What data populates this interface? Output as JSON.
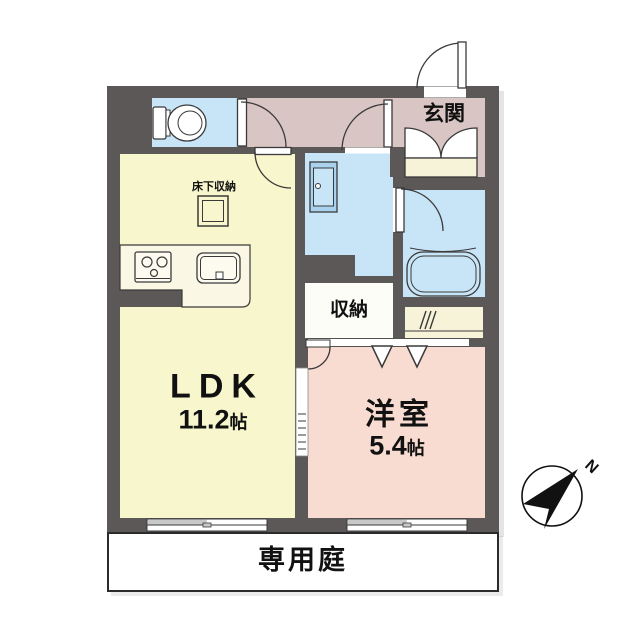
{
  "plan": {
    "type": "apartment-floor-plan",
    "rooms": {
      "ldk": {
        "name": "LDK",
        "size": "11.2",
        "unit": "帖"
      },
      "western_room": {
        "name": "洋室",
        "size": "5.4",
        "unit": "帖"
      },
      "entrance": {
        "name": "玄関"
      },
      "storage": {
        "name": "収納"
      },
      "underfloor_storage": {
        "name": "床下収納"
      },
      "private_garden": {
        "name": "専用庭"
      },
      "toilet": {
        "name": ""
      },
      "washroom": {
        "name": ""
      },
      "bathroom": {
        "name": ""
      }
    },
    "fixtures": [
      "toilet",
      "washbasin-vanity",
      "bathtub",
      "kitchen-stove",
      "kitchen-sink",
      "shoe-cabinet",
      "underfloor-storage-hatch",
      "sliding-window",
      "sliding-window",
      "folding-closet-doors",
      "pocket-sliding-door",
      "hinged-doors",
      "closet-shelf"
    ],
    "compass": {
      "north_label": "N",
      "direction": "north-east"
    },
    "colors": {
      "wall": "#5b5857",
      "ldk_floor": "#f8f6cd",
      "wet_area_floor": "#c8e4f7",
      "hall_entrance_floor": "#d9c6c4",
      "western_room_floor": "#f8dcd1",
      "storage_floor": "#fdfdf7",
      "closet_floor": "#f7f3d8",
      "counter": "#faf7e5",
      "outline": "#3a3a3a",
      "background": "#ffffff"
    }
  }
}
